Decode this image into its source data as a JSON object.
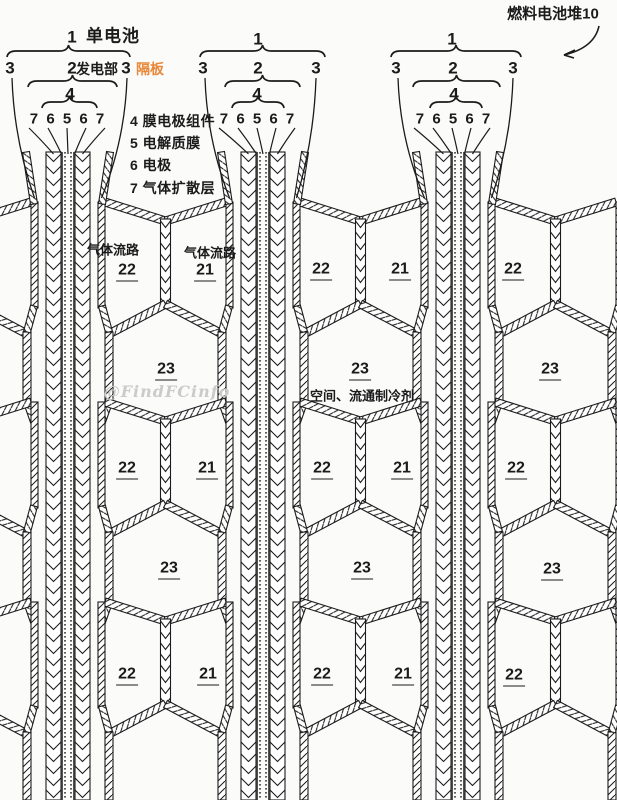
{
  "title": "燃料电池堆10",
  "colors": {
    "ink": "#1b1b1b",
    "accent_orange": "#e8893a",
    "watermark_gray": "#cbcbc8",
    "background": "#fbfbfa"
  },
  "legend_lines": [
    {
      "text": "4 膜电极组件",
      "x": 130,
      "y": 121
    },
    {
      "text": "5 电解质膜",
      "x": 130,
      "y": 143
    },
    {
      "text": "6 电极",
      "x": 130,
      "y": 165
    },
    {
      "text": "7 气体扩散层",
      "x": 130,
      "y": 188
    }
  ],
  "labels": [
    {
      "t": "燃料电池堆10",
      "x": 553,
      "y": 14,
      "k": "title"
    },
    {
      "t": "1",
      "x": 72,
      "y": 37,
      "k": "hnum"
    },
    {
      "t": "单电池",
      "x": 113,
      "y": 36,
      "k": "htext"
    },
    {
      "t": "3",
      "x": 10,
      "y": 68,
      "k": "hnum"
    },
    {
      "t": "2",
      "x": 72,
      "y": 68,
      "k": "hnum"
    },
    {
      "t": "发电部",
      "x": 97,
      "y": 69,
      "k": "htext15"
    },
    {
      "t": "3",
      "x": 126,
      "y": 68,
      "k": "hnum"
    },
    {
      "t": "隔板",
      "x": 150,
      "y": 69,
      "k": "orange"
    },
    {
      "t": "4",
      "x": 70,
      "y": 94,
      "k": "hnum"
    },
    {
      "t": "7 6 5 6 7",
      "x": 68,
      "y": 119,
      "k": "digits"
    },
    {
      "t": "1",
      "x": 258,
      "y": 39,
      "k": "hnum"
    },
    {
      "t": "3",
      "x": 203,
      "y": 68,
      "k": "hnum"
    },
    {
      "t": "2",
      "x": 258,
      "y": 68,
      "k": "hnum"
    },
    {
      "t": "3",
      "x": 316,
      "y": 68,
      "k": "hnum"
    },
    {
      "t": "4",
      "x": 257,
      "y": 94,
      "k": "hnum"
    },
    {
      "t": "7 6 5 6 7",
      "x": 258,
      "y": 119,
      "k": "digits"
    },
    {
      "t": "1",
      "x": 452,
      "y": 39,
      "k": "hnum"
    },
    {
      "t": "3",
      "x": 396,
      "y": 68,
      "k": "hnum"
    },
    {
      "t": "2",
      "x": 453,
      "y": 68,
      "k": "hnum"
    },
    {
      "t": "3",
      "x": 513,
      "y": 68,
      "k": "hnum"
    },
    {
      "t": "4",
      "x": 454,
      "y": 94,
      "k": "hnum"
    },
    {
      "t": "7 6 5 6 7",
      "x": 454,
      "y": 119,
      "k": "digits"
    },
    {
      "t": "气体流路",
      "x": 113,
      "y": 250,
      "k": "flow"
    },
    {
      "t": "气体流路",
      "x": 210,
      "y": 253,
      "k": "flow"
    },
    {
      "t": "空间、流通制冷剂",
      "x": 362,
      "y": 396,
      "k": "flow"
    },
    {
      "t": "@FindFCinfo",
      "x": 167,
      "y": 392,
      "k": "wm"
    },
    {
      "t": "22",
      "x": 127,
      "y": 272,
      "k": "num"
    },
    {
      "t": "21",
      "x": 205,
      "y": 272,
      "k": "num"
    },
    {
      "t": "22",
      "x": 321,
      "y": 271,
      "k": "num"
    },
    {
      "t": "21",
      "x": 400,
      "y": 271,
      "k": "num"
    },
    {
      "t": "22",
      "x": 513,
      "y": 271,
      "k": "num"
    },
    {
      "t": "23",
      "x": 166,
      "y": 371,
      "k": "num"
    },
    {
      "t": "23",
      "x": 360,
      "y": 371,
      "k": "num"
    },
    {
      "t": "23",
      "x": 550,
      "y": 371,
      "k": "num"
    },
    {
      "t": "22",
      "x": 127,
      "y": 470,
      "k": "num"
    },
    {
      "t": "21",
      "x": 207,
      "y": 470,
      "k": "num"
    },
    {
      "t": "22",
      "x": 322,
      "y": 470,
      "k": "num"
    },
    {
      "t": "21",
      "x": 402,
      "y": 470,
      "k": "num"
    },
    {
      "t": "22",
      "x": 516,
      "y": 470,
      "k": "num"
    },
    {
      "t": "23",
      "x": 169,
      "y": 570,
      "k": "num"
    },
    {
      "t": "23",
      "x": 362,
      "y": 570,
      "k": "num"
    },
    {
      "t": "23",
      "x": 552,
      "y": 571,
      "k": "num"
    },
    {
      "t": "22",
      "x": 127,
      "y": 676,
      "k": "num"
    },
    {
      "t": "21",
      "x": 208,
      "y": 676,
      "k": "num"
    },
    {
      "t": "22",
      "x": 322,
      "y": 676,
      "k": "num"
    },
    {
      "t": "21",
      "x": 403,
      "y": 676,
      "k": "num"
    },
    {
      "t": "22",
      "x": 514,
      "y": 677,
      "k": "num"
    }
  ]
}
